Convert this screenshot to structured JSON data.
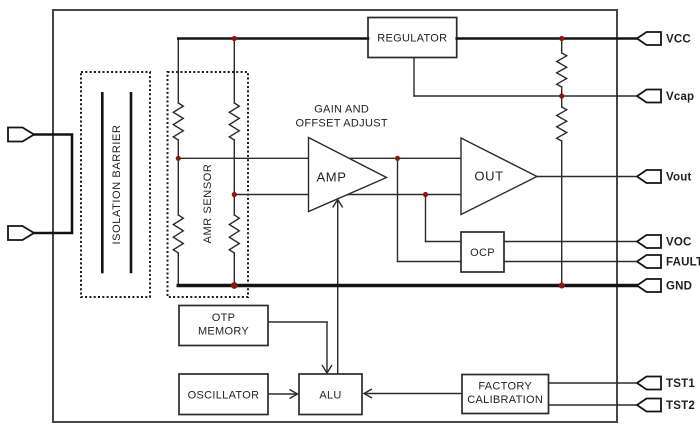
{
  "blocks": {
    "regulator": {
      "label": "REGULATOR"
    },
    "isolation_barrier": {
      "label": "ISOLATION BARRIER"
    },
    "amr_sensor": {
      "label": "AMR SENSOR"
    },
    "amp": {
      "label": "AMP",
      "annotation_line1": "GAIN AND",
      "annotation_line2": "OFFSET ADJUST"
    },
    "out_driver": {
      "label": "OUT"
    },
    "ocp": {
      "label": "OCP"
    },
    "otp_memory": {
      "label_line1": "OTP",
      "label_line2": "MEMORY"
    },
    "oscillator": {
      "label": "OSCILLATOR"
    },
    "alu": {
      "label": "ALU"
    },
    "factory_calibration": {
      "label_line1": "FACTORY",
      "label_line2": "CALIBRATION"
    }
  },
  "pins": {
    "vcc": {
      "label": "VCC"
    },
    "vcap": {
      "label": "Vcap"
    },
    "vout": {
      "label": "Vout"
    },
    "voc": {
      "label": "VOC"
    },
    "fault": {
      "label": "FAULT"
    },
    "gnd": {
      "label": "GND"
    },
    "tst1": {
      "label": "TST1"
    },
    "tst2": {
      "label": "TST2"
    }
  },
  "colors": {
    "background": "#ffffff",
    "wire": "#2b2b2b",
    "bus": "#141414",
    "junction_dot": "#8c1616",
    "outer_border": "#474747",
    "text": "#1f1f1f"
  }
}
